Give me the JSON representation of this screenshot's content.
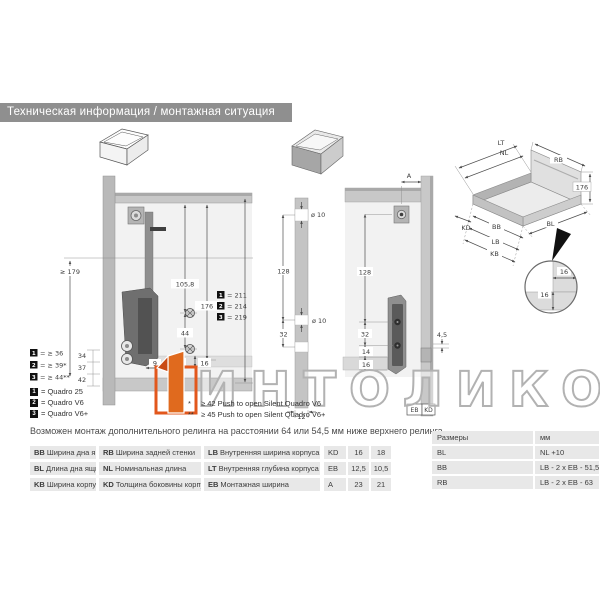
{
  "header": {
    "title": "Техническая информация / монтажная ситуация"
  },
  "watermark": {
    "brand": "ИНТОЛИКО"
  },
  "icons": {
    "left": "open-drawer-outline-icon",
    "middle": "drawer-solid-front-icon"
  },
  "left": {
    "d179": "≥ 179",
    "d105_8": "105,8",
    "d176": "176",
    "d44": "44",
    "d9": "9",
    "d10": "10",
    "d16": "16",
    "variants": [
      {
        "num": "1",
        "val": "= 211"
      },
      {
        "num": "2",
        "val": "= 214"
      },
      {
        "num": "3",
        "val": "= 219"
      }
    ],
    "front_variants": [
      {
        "num": "1",
        "val": "= ≥ 36",
        "dim": "34"
      },
      {
        "num": "2",
        "val": "= ≥ 39*",
        "dim": "37"
      },
      {
        "num": "3",
        "val": "= ≥ 44**",
        "dim": "42"
      }
    ],
    "legend": [
      {
        "num": "1",
        "label": "= Quadro 25"
      },
      {
        "num": "2",
        "label": "= Quadro V6"
      },
      {
        "num": "3",
        "label": "= Quadro V6+"
      }
    ],
    "footnotes": [
      {
        "mark": "*",
        "text": "≥ 42 Push to open Silent Quadro V6"
      },
      {
        "mark": "**",
        "text": "≥ 45 Push to open Silent Quadro V6+"
      }
    ]
  },
  "middle": {
    "strip": {
      "dia_top": "ø 10",
      "d128": "128",
      "dia_mid": "ø 10",
      "d32": "32",
      "d12": "12"
    },
    "panel": {
      "a": "A",
      "d128": "128",
      "d32": "32",
      "d14": "14",
      "d16": "16",
      "d4_5": "4,5",
      "eb": "EB",
      "kd": "KD"
    }
  },
  "right": {
    "lt": "LT",
    "nl": "NL",
    "rb": "RB",
    "d176": "176",
    "kd": "KD",
    "bb": "BB",
    "bl": "BL",
    "lb": "LB",
    "kb": "KB",
    "detail": {
      "d16_h": "16",
      "d16_v": "16"
    }
  },
  "note": "Возможен монтаж дополнительного релинга на расстоянии 64 или 54,5 мм ниже верхнего релинга.",
  "glossary": [
    [
      {
        "abbr": "BB",
        "text": "Ширина дна ящика"
      },
      {
        "abbr": "RB",
        "text": "Ширина задней стенки"
      },
      {
        "abbr": "LB",
        "text": "Внутренняя ширина корпуса"
      }
    ],
    [
      {
        "abbr": "BL",
        "text": "Длина дна ящика"
      },
      {
        "abbr": "NL",
        "text": "Номинальная длина"
      },
      {
        "abbr": "LT",
        "text": "Внутренняя глубина корпуса"
      }
    ],
    [
      {
        "abbr": "KB",
        "text": "Ширина корпуса"
      },
      {
        "abbr": "KD",
        "text": "Толщина боковины корпуса"
      },
      {
        "abbr": "EB",
        "text": "Монтажная ширина"
      }
    ]
  ],
  "mini_table": {
    "rows": [
      [
        "KD",
        "16",
        "18"
      ],
      [
        "EB",
        "12,5",
        "10,5"
      ],
      [
        "A",
        "23",
        "21"
      ]
    ]
  },
  "size_table": {
    "header": {
      "name": "Размеры",
      "unit": "мм"
    },
    "rows": [
      {
        "abbr": "BL",
        "formula": "NL +10"
      },
      {
        "abbr": "BB",
        "formula": "LB - 2 x EB - 51,5"
      },
      {
        "abbr": "RB",
        "formula": "LB - 2 x EB - 63"
      }
    ]
  }
}
